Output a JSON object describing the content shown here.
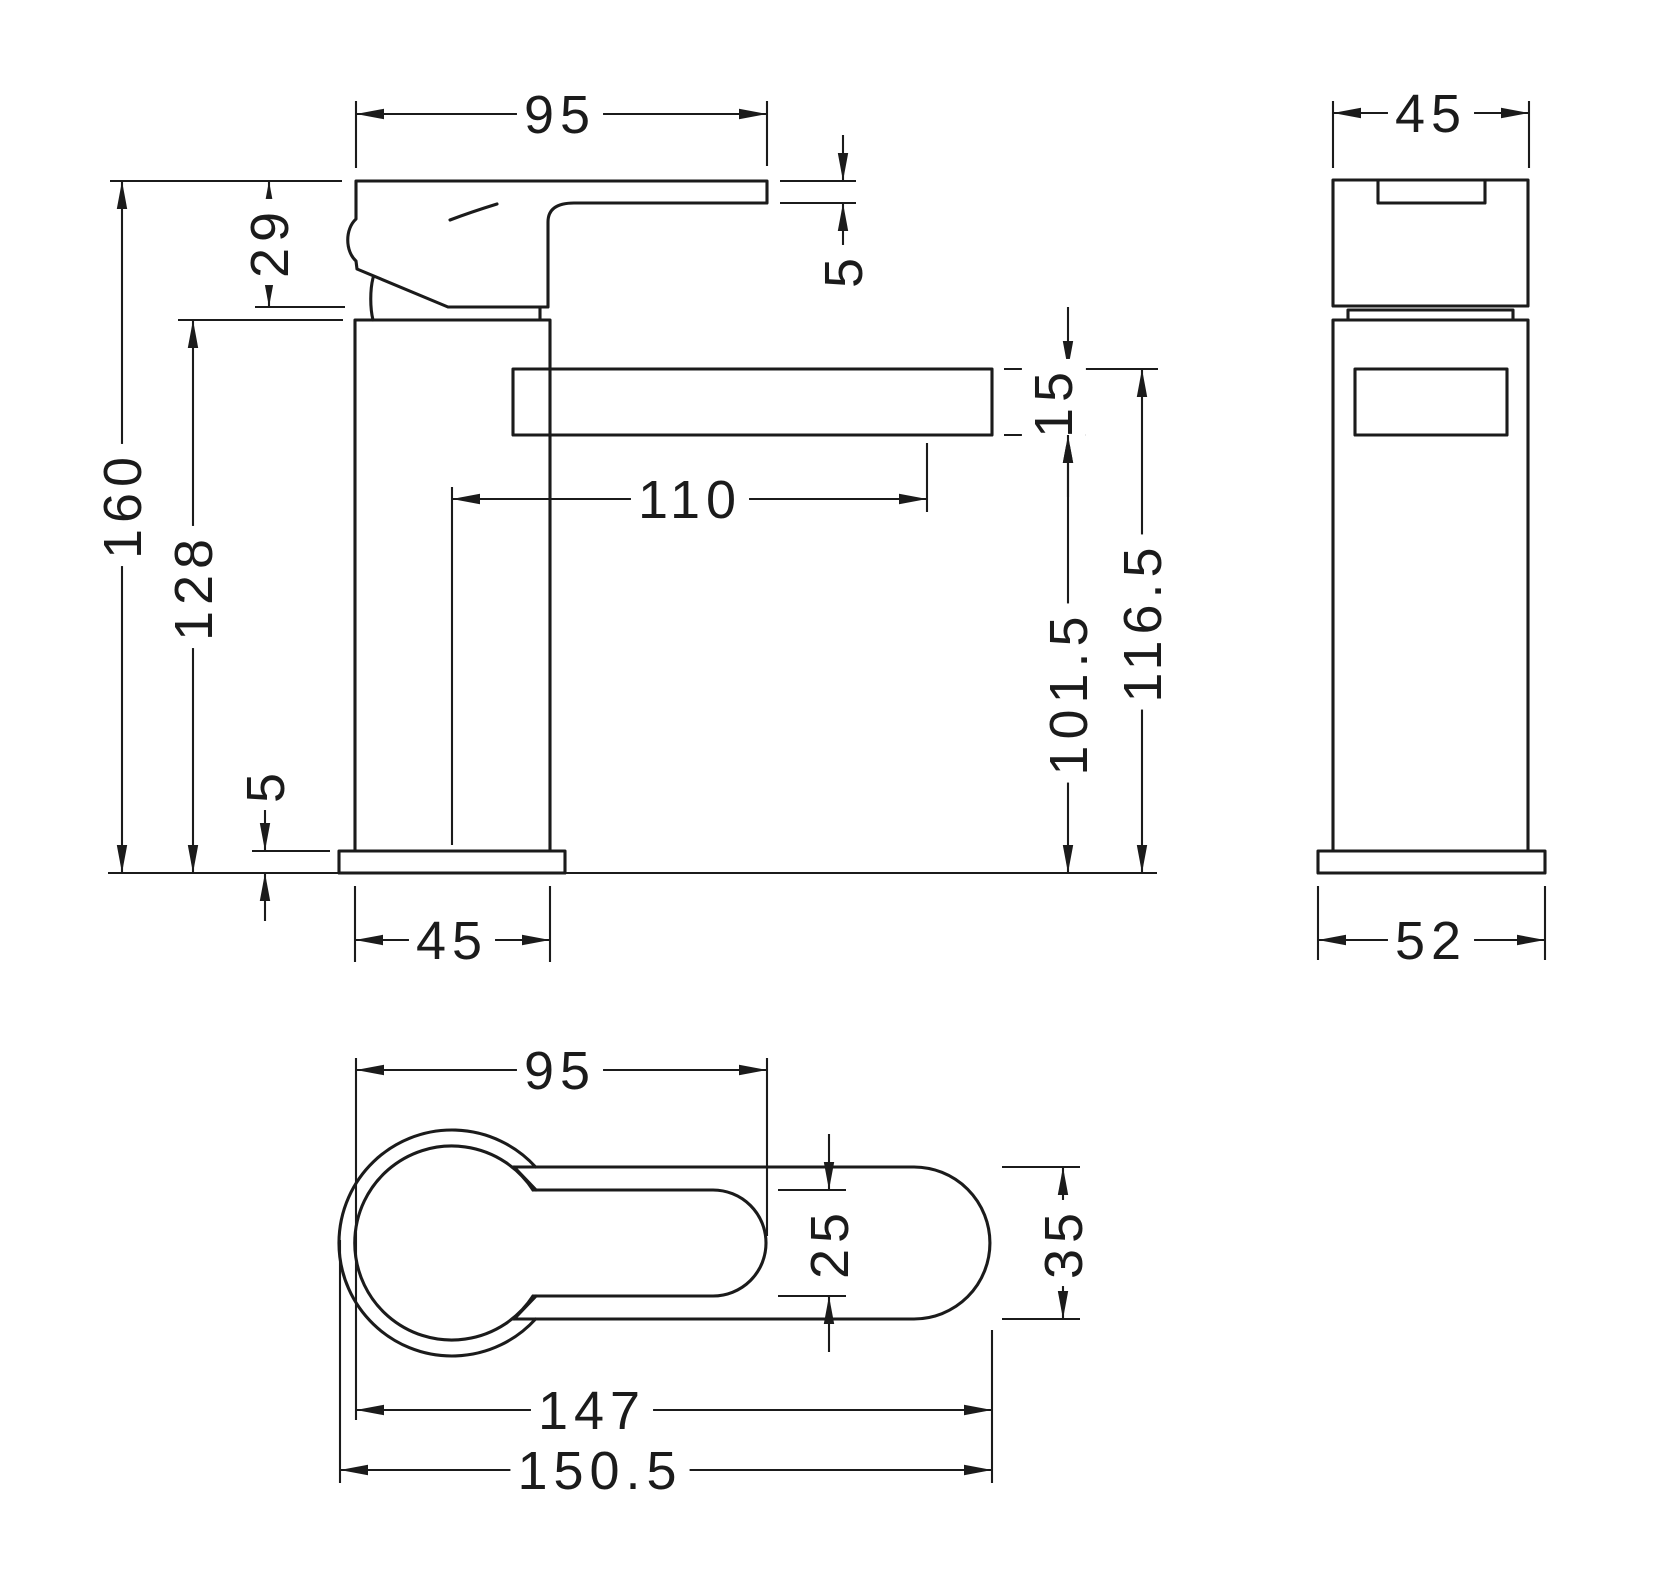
{
  "drawing": {
    "type": "technical-drawing",
    "background": "#ffffff",
    "line_color": "#1b1b1b",
    "font_size": 54,
    "views": [
      {
        "id": "side-view",
        "dimensions": [
          {
            "value": "95",
            "dir": "h",
            "style": "in",
            "a": 356,
            "b": 767,
            "pos": 114,
            "label_at": 560,
            "ext": [
              [
                356,
                101,
                356,
                168
              ],
              [
                767,
                101,
                767,
                166
              ]
            ]
          },
          {
            "value": "5",
            "dir": "v",
            "style": "out",
            "a": 181,
            "b": 203,
            "pos": 843,
            "tail": 46,
            "label_at": 270,
            "ext": [
              [
                780,
                181,
                856,
                181
              ],
              [
                780,
                203,
                856,
                203
              ]
            ]
          },
          {
            "value": "29",
            "dir": "v",
            "style": "in",
            "a": 181,
            "b": 307,
            "pos": 269,
            "label_at": 242,
            "ext": [
              [
                110,
                181,
                342,
                181
              ],
              [
                255,
                307,
                345,
                307
              ]
            ]
          },
          {
            "value": "160",
            "dir": "v",
            "style": "in",
            "a": 181,
            "b": 873,
            "pos": 122,
            "label_at": 505,
            "ext": []
          },
          {
            "value": "128",
            "dir": "v",
            "style": "in",
            "a": 320,
            "b": 873,
            "pos": 193,
            "label_at": 587,
            "ext": [
              [
                178,
                320,
                343,
                320
              ]
            ]
          },
          {
            "value": "110",
            "dir": "h",
            "style": "in",
            "a": 452,
            "b": 927,
            "pos": 499,
            "label_at": 690,
            "ext": [
              [
                927,
                443,
                927,
                512
              ]
            ]
          },
          {
            "value": "15",
            "dir": "v",
            "style": "out",
            "a": 369,
            "b": 435,
            "pos": 1068,
            "tail": 62,
            "label_at": 402,
            "label_off": -15,
            "ext": [
              [
                1004,
                369,
                1158,
                369
              ],
              [
                1004,
                435,
                1086,
                435
              ]
            ]
          },
          {
            "value": "101.5",
            "dir": "v",
            "style": "in",
            "a": 435,
            "b": 873,
            "pos": 1068,
            "label_at": 693,
            "ext": []
          },
          {
            "value": "116.5",
            "dir": "v",
            "style": "in",
            "a": 369,
            "b": 873,
            "pos": 1142,
            "label_at": 622,
            "ext": []
          },
          {
            "value": "5",
            "dir": "v",
            "style": "out",
            "a": 851,
            "b": 873,
            "pos": 265,
            "tail": 48,
            "label_at": 785,
            "ext": [
              [
                252,
                851,
                330,
                851
              ]
            ]
          },
          {
            "value": "45",
            "dir": "h",
            "style": "in",
            "a": 355,
            "b": 550,
            "pos": 940,
            "label_at": 452,
            "ext": [
              [
                355,
                886,
                355,
                962
              ],
              [
                550,
                886,
                550,
                962
              ]
            ]
          }
        ]
      },
      {
        "id": "front-view",
        "dimensions": [
          {
            "value": "45",
            "dir": "h",
            "style": "in",
            "a": 1333,
            "b": 1529,
            "pos": 113,
            "label_at": 1431,
            "ext": [
              [
                1333,
                101,
                1333,
                168
              ],
              [
                1529,
                101,
                1529,
                168
              ]
            ]
          },
          {
            "value": "52",
            "dir": "h",
            "style": "in",
            "a": 1318,
            "b": 1545,
            "pos": 940,
            "label_at": 1431,
            "ext": [
              [
                1318,
                886,
                1318,
                960
              ],
              [
                1545,
                886,
                1545,
                960
              ]
            ]
          }
        ]
      },
      {
        "id": "top-view",
        "dimensions": [
          {
            "value": "95",
            "dir": "h",
            "style": "in",
            "a": 356,
            "b": 767,
            "pos": 1070,
            "label_at": 560,
            "ext": [
              [
                356,
                1058,
                356,
                1420
              ],
              [
                767,
                1058,
                767,
                1236
              ]
            ]
          },
          {
            "value": "25",
            "dir": "v",
            "style": "out",
            "a": 1190,
            "b": 1296,
            "pos": 829,
            "tail": 56,
            "label_at": 1243,
            "ext": [
              [
                778,
                1190,
                846,
                1190
              ],
              [
                778,
                1296,
                846,
                1296
              ]
            ]
          },
          {
            "value": "35",
            "dir": "v",
            "style": "in",
            "a": 1167,
            "b": 1319,
            "pos": 1063,
            "label_at": 1243,
            "ext": [
              [
                1002,
                1167,
                1080,
                1167
              ],
              [
                1002,
                1319,
                1080,
                1319
              ]
            ]
          },
          {
            "value": "147",
            "dir": "h",
            "style": "in",
            "a": 356,
            "b": 992,
            "pos": 1410,
            "label_at": 592,
            "ext": [
              [
                992,
                1330,
                992,
                1483
              ]
            ]
          },
          {
            "value": "150.5",
            "dir": "h",
            "style": "in",
            "a": 340,
            "b": 992,
            "pos": 1470,
            "label_at": 600,
            "ext": [
              [
                340,
                1240,
                340,
                1483
              ]
            ]
          }
        ]
      }
    ]
  }
}
